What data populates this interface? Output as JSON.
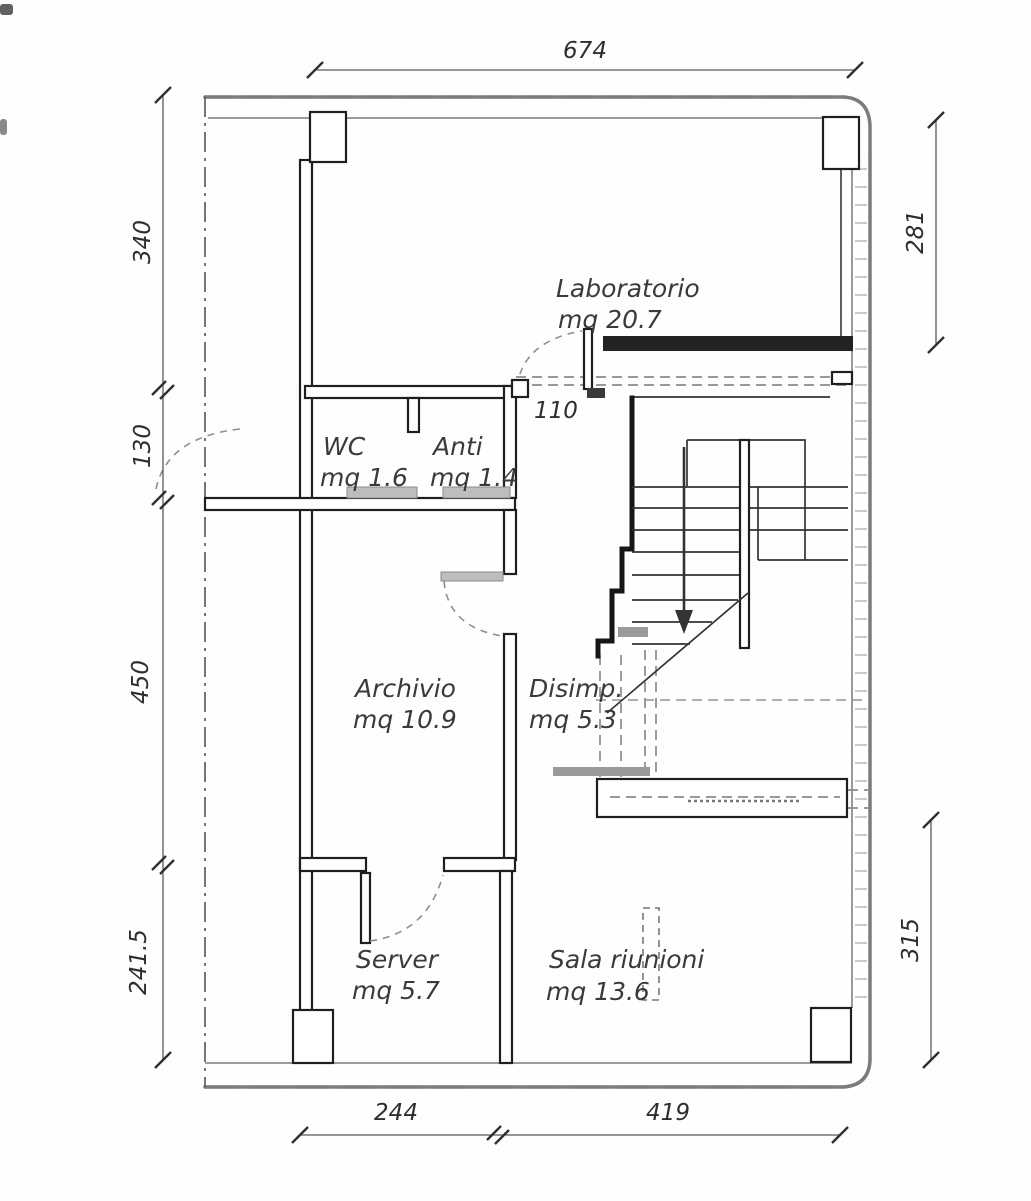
{
  "drawing_type": "floor-plan",
  "rooms": {
    "laboratorio": {
      "name": "Laboratorio",
      "area": "mq 20.7"
    },
    "wc": {
      "name": "WC",
      "area": "mq 1.6"
    },
    "anti": {
      "name": "Anti",
      "area": "mq 1.4"
    },
    "archivio": {
      "name": "Archivio",
      "area": "mq 10.9"
    },
    "disimp": {
      "name": "Disimp.",
      "area": "mq 5.3"
    },
    "server": {
      "name": "Server",
      "area": "mq 5.7"
    },
    "sala_riunioni": {
      "name": "Sala riunioni",
      "area": "mq 13.6"
    }
  },
  "dims": {
    "top": "674",
    "left_top": "340",
    "left_upper_mid": "130",
    "left_lower_mid": "450",
    "left_bottom": "241.5",
    "right_top": "281",
    "right_bottom": "315",
    "bottom_left": "244",
    "bottom_right": "419",
    "lab_door": "110"
  },
  "colors": {
    "ink": "#2a2a2a",
    "soft_gray": "#8a8a8a",
    "paper": "#fefefe"
  }
}
